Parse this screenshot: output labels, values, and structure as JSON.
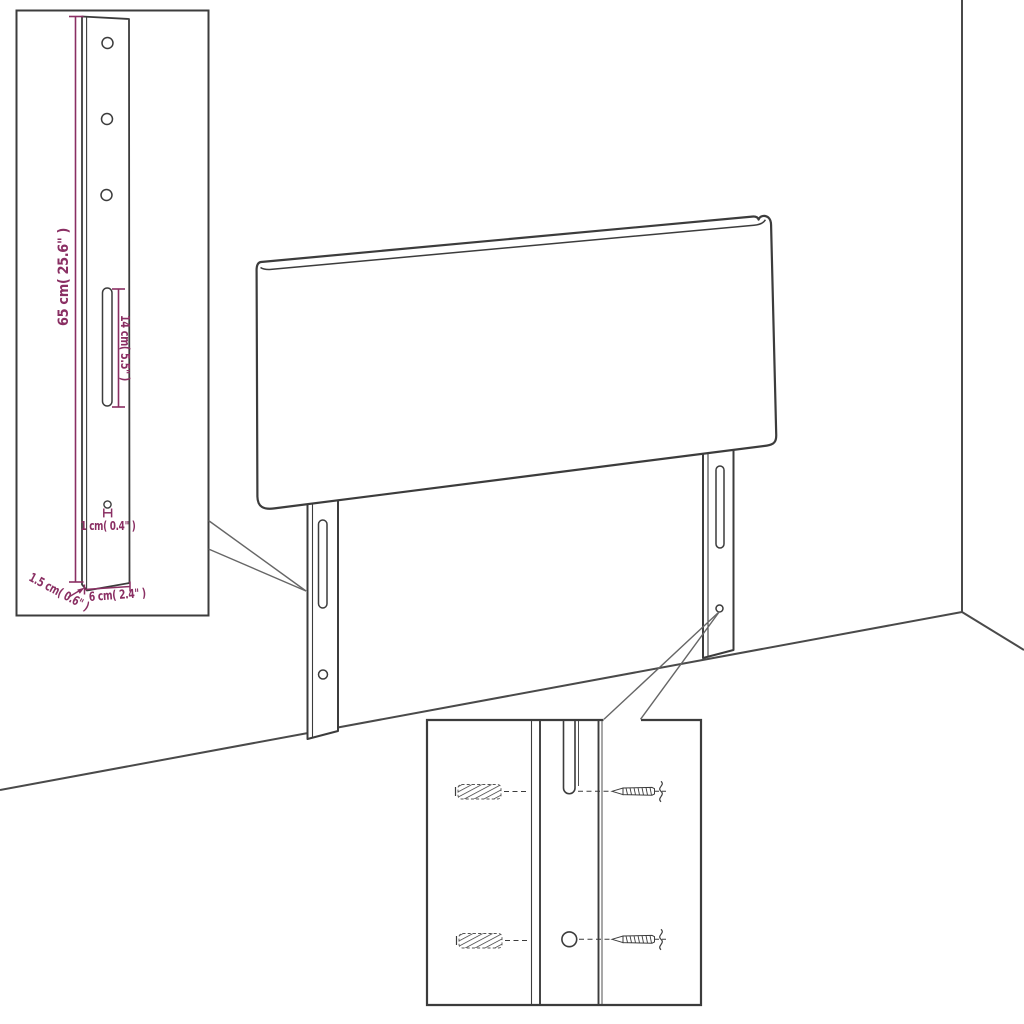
{
  "diagram": {
    "subject": "headboard-with-mounting-legs-dimension-diagram",
    "colors": {
      "background": "#ffffff",
      "figure_line": "#3c3c3c",
      "wall_line": "#4a4a4a",
      "leader_line": "#666666",
      "dimension": "#8a2f63"
    },
    "bracket_inset": {
      "dimensions": {
        "height": "65 cm( 25.6\" )",
        "slot_length": "14 cm( 5.5\" )",
        "hole": "1 cm( 0.4\" )",
        "width": "6 cm( 2.4\" )",
        "thickness": "1.5 cm( 0.6\" )"
      }
    },
    "mounting_inset": {
      "icons": [
        "wall-plug-icon",
        "screw-icon",
        "wall-break-squiggle-icon"
      ]
    }
  }
}
